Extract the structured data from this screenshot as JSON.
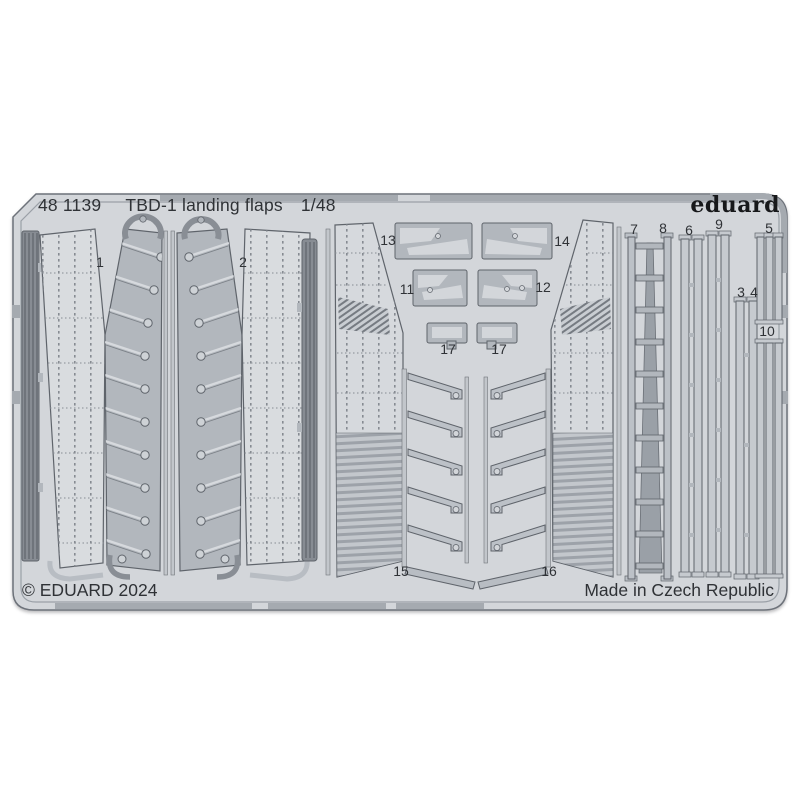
{
  "sheet": {
    "header": {
      "catalog_number": "48 1139",
      "product_name": "TBD-1 landing flaps",
      "scale": "1/48"
    },
    "brand_logo": "eduard",
    "footer": {
      "copyright": "© EDUARD 2024",
      "made_in": "Made in Czech Republic"
    },
    "part_labels": [
      "1",
      "2",
      "13",
      "14",
      "11",
      "12",
      "17",
      "17",
      "15",
      "16",
      "7",
      "8",
      "6",
      "9",
      "5",
      "3",
      "4",
      "10"
    ]
  },
  "colors": {
    "sheet_base": "#d3d6da",
    "part_gray": "#b2b7bd",
    "light_panel": "#d9dcdf",
    "rail": "#c2c6cb",
    "dark_strip": "#878c93",
    "outline": "#5f646b",
    "frame_bar": "#a5aab0",
    "text": "#2f3236"
  }
}
